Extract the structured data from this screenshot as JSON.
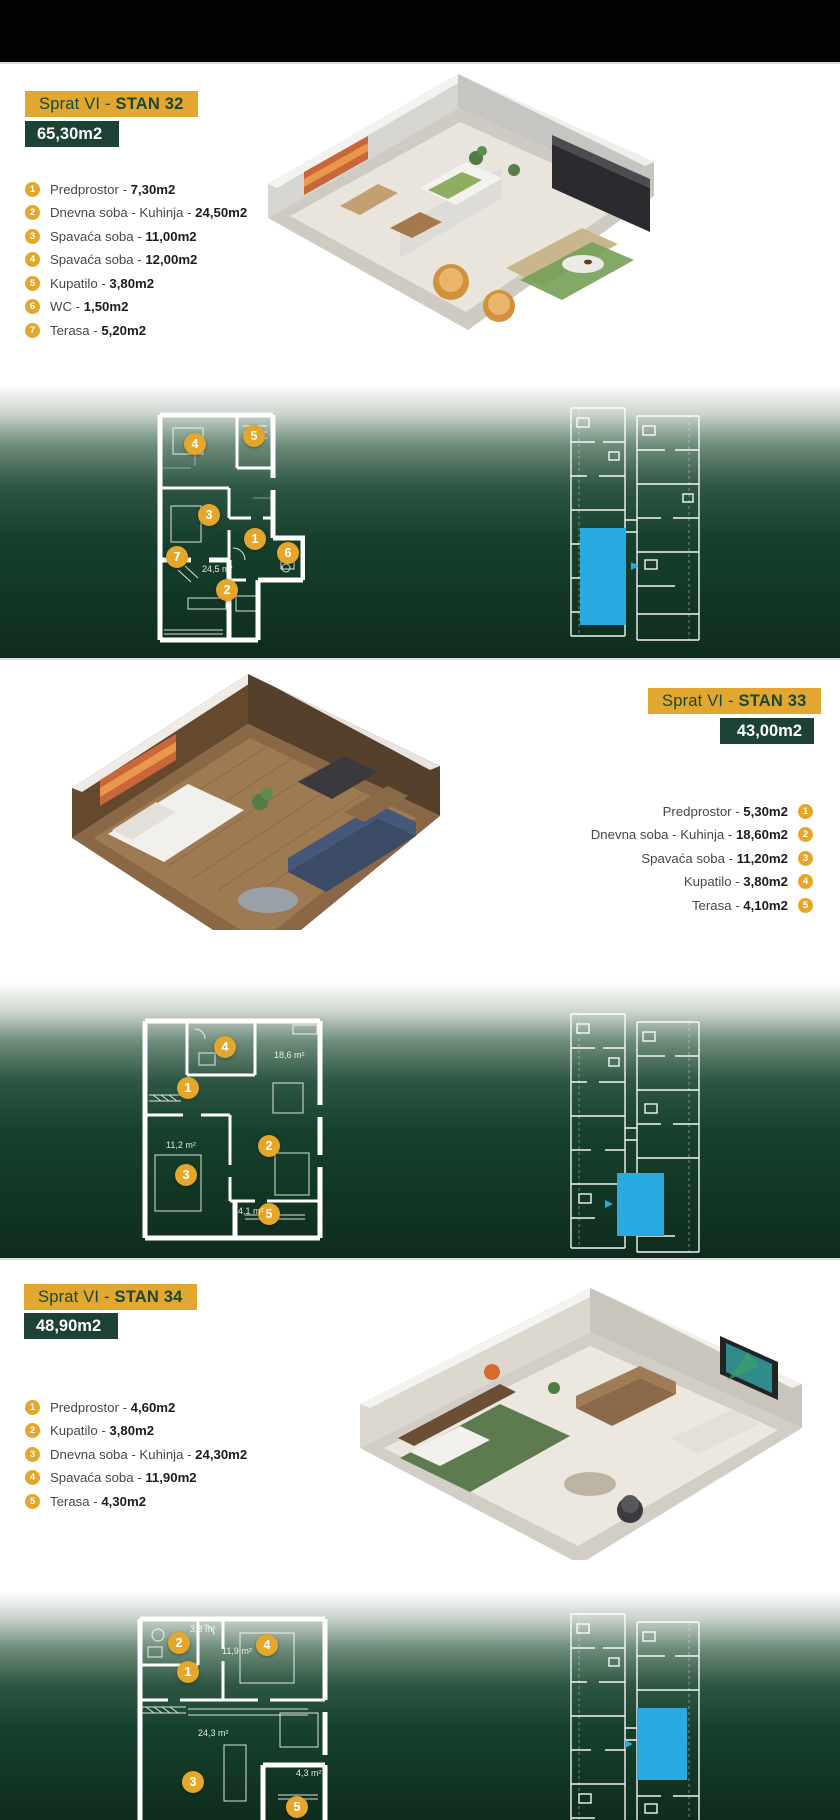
{
  "colors": {
    "gold": "#E2A72E",
    "dark_green": "#1B4232",
    "band_deep_green": "#0E2C1D",
    "unit_highlight_cyan": "#29ABE2",
    "marker_gold": "#E4A62B"
  },
  "sections": [
    {
      "header": {
        "prefix": "Sprat VI - ",
        "name": "STAN 32"
      },
      "area": "65,30m2",
      "rooms": [
        {
          "num": "1",
          "label": "Predprostor - ",
          "value": "7,30m2"
        },
        {
          "num": "2",
          "label": "Dnevna soba - Kuhinja - ",
          "value": "24,50m2"
        },
        {
          "num": "3",
          "label": "Spavaća soba - ",
          "value": "11,00m2"
        },
        {
          "num": "4",
          "label": "Spavaća soba - ",
          "value": "12,00m2"
        },
        {
          "num": "5",
          "label": "Kupatilo - ",
          "value": "3,80m2"
        },
        {
          "num": "6",
          "label": "WC - ",
          "value": "1,50m2"
        },
        {
          "num": "7",
          "label": "Terasa - ",
          "value": "5,20m2"
        }
      ],
      "plan_labels": [
        "24,5 m²"
      ]
    },
    {
      "header": {
        "prefix": "Sprat VI - ",
        "name": "STAN 33"
      },
      "area": "43,00m2",
      "rooms": [
        {
          "num": "1",
          "label": "Predprostor - ",
          "value": "5,30m2"
        },
        {
          "num": "2",
          "label": "Dnevna soba - Kuhinja - ",
          "value": "18,60m2"
        },
        {
          "num": "3",
          "label": "Spavaća soba - ",
          "value": "11,20m2"
        },
        {
          "num": "4",
          "label": "Kupatilo - ",
          "value": "3,80m2"
        },
        {
          "num": "5",
          "label": "Terasa - ",
          "value": "4,10m2"
        }
      ],
      "plan_labels": [
        "18,6 m²",
        "11,2 m²",
        "4,1 m²"
      ]
    },
    {
      "header": {
        "prefix": "Sprat VI - ",
        "name": "STAN 34"
      },
      "area": "48,90m2",
      "rooms": [
        {
          "num": "1",
          "label": "Predprostor - ",
          "value": "4,60m2"
        },
        {
          "num": "2",
          "label": "Kupatilo - ",
          "value": "3,80m2"
        },
        {
          "num": "3",
          "label": "Dnevna soba - Kuhinja - ",
          "value": "24,30m2"
        },
        {
          "num": "4",
          "label": "Spavaća soba - ",
          "value": "11,90m2"
        },
        {
          "num": "5",
          "label": "Terasa - ",
          "value": "4,30m2"
        }
      ],
      "plan_labels": [
        "3,8 m²",
        "11,9 m²",
        "24,3 m²",
        "4,3 m²"
      ]
    }
  ]
}
